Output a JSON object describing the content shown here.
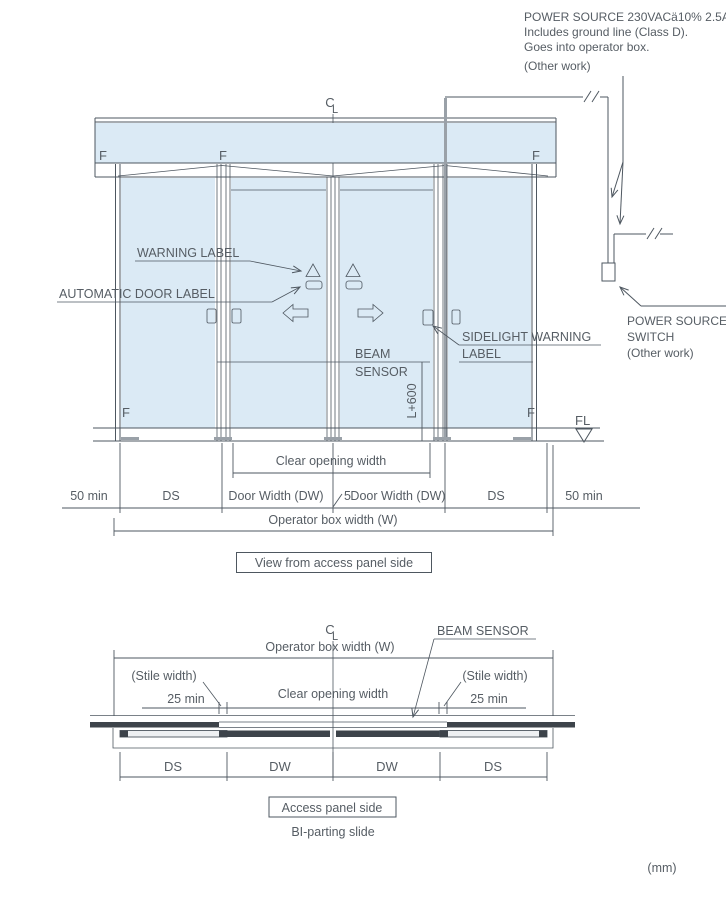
{
  "colors": {
    "line": "#4e5760",
    "text": "#565d64",
    "glass_fill": "#dbeaf5",
    "dark_fill": "#3d434a",
    "conduit_gray": "#9aa1a8"
  },
  "units_label": "(mm)",
  "power_note": {
    "line1": "POWER SOURCE 230VACä10% 2.5A",
    "line2": "Includes ground line (Class D).",
    "line3": "Goes into operator box.",
    "line4": "(Other work)"
  },
  "power_switch": {
    "line1": "POWER SOURCE",
    "line2": "SWITCH",
    "line3": "(Other work)"
  },
  "elevation": {
    "caption": "View from access panel side",
    "centerline": {
      "c": "C",
      "l": "L"
    },
    "f_label": "F",
    "fl_label": "FL",
    "labels": {
      "warning": "WARNING LABEL",
      "automatic_door": "AUTOMATIC DOOR LABEL",
      "sidelight1": "SIDELIGHT WARNING",
      "sidelight2": "LABEL",
      "beam1": "BEAM",
      "beam2": "SENSOR",
      "beam_height": "L+600"
    },
    "dims": {
      "clear_opening": "Clear opening width",
      "margin_left": "50 min",
      "ds_left": "DS",
      "dw_left": "Door Width (DW)",
      "gap": "5",
      "dw_right": "Door Width (DW)",
      "ds_right": "DS",
      "margin_right": "50 min",
      "operator_box": "Operator box width (W)"
    }
  },
  "plan": {
    "caption": "Access panel side",
    "subtitle": "BI-parting slide",
    "centerline": {
      "c": "C",
      "l": "L"
    },
    "labels": {
      "beam_sensor": "BEAM SENSOR"
    },
    "dims": {
      "operator_box": "Operator box width (W)",
      "stile_width_left": "(Stile width)",
      "stile_min_left": "25 min",
      "clear_opening": "Clear opening width",
      "stile_width_right": "(Stile width)",
      "stile_min_right": "25 min",
      "ds_left": "DS",
      "dw_left": "DW",
      "dw_right": "DW",
      "ds_right": "DS"
    }
  }
}
